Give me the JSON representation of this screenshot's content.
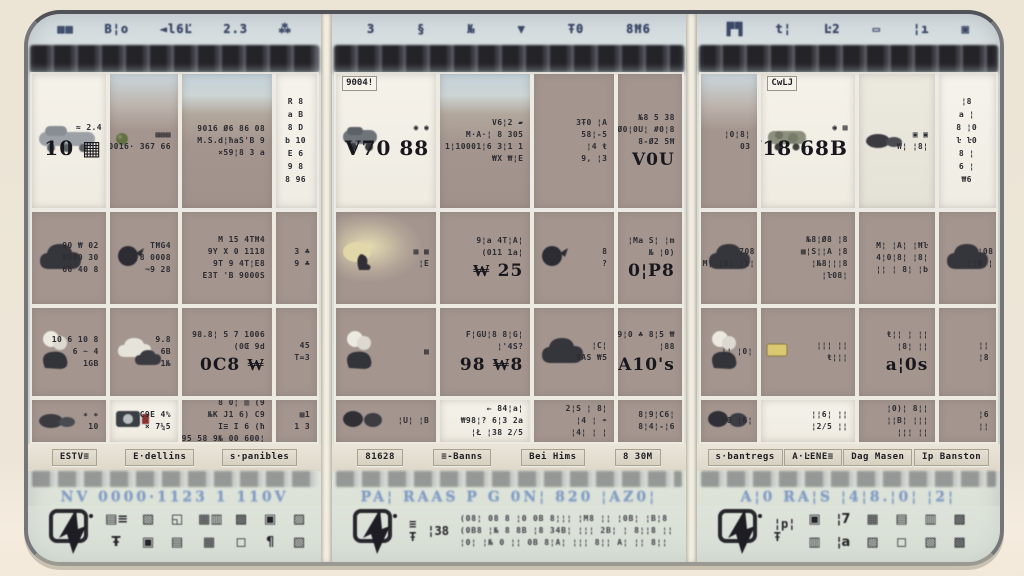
{
  "palette": {
    "outer_bg": "#ece5d6",
    "card_bg": "#d8dcd4",
    "cell_taupe": "#a5968e",
    "cell_white": "#f4f0e7",
    "band_dark": "#2c2c31",
    "blue_text": "#7e9cc7",
    "ink": "#24242a",
    "tab_bg": "#ded8c9",
    "red_accent": "#8d2f2f"
  },
  "panels": [
    {
      "top_glyphs": [
        "▩▦",
        "B¦o",
        "◄l6Ľ",
        "2.3",
        "⁂"
      ],
      "cells": [
        {
          "bg": "white",
          "caption": "",
          "icon": "truck-icon",
          "lines": [
            "≈ 2.4"
          ],
          "big": "10 ▦"
        },
        {
          "bg": "taupe1",
          "caption": "",
          "icon": "dot-green-icon",
          "lines": [
            "▦▦▦",
            "0016· 367 66"
          ],
          "big": ""
        },
        {
          "bg": "photo",
          "caption": "",
          "icon": "",
          "lines": [
            "9016 Ø6 86 08",
            "M.S.d¦ħaS'B 9",
            "×59¦8 3 a"
          ],
          "big": ""
        },
        {
          "bg": "strip",
          "caption": "",
          "icon": "",
          "lines": [
            "R 8",
            "a B",
            "8 D",
            "b 10",
            "E 6",
            "9 8",
            "8 96"
          ],
          "big": ""
        },
        {
          "bg": "taupe",
          "caption": "",
          "icon": "cloud-dark-icon",
          "lines": [
            "90 ₩ 02",
            "0900 30",
            "66 40 8"
          ],
          "big": ""
        },
        {
          "bg": "taupe",
          "caption": "",
          "icon": "bird-icon",
          "lines": [
            "TĦG4",
            "8 0008",
            "¬9 28"
          ],
          "big": ""
        },
        {
          "bg": "taupe",
          "caption": "",
          "icon": "",
          "lines": [
            "M 15 4TĦ4",
            "9Y X 0 1118",
            "9T 9 4T¦E8",
            "E3T 'B 9000S"
          ],
          "big": ""
        },
        {
          "bg": "taupe",
          "caption": "",
          "icon": "",
          "lines": [
            "3 ♣",
            "9 ♣"
          ],
          "big": ""
        },
        {
          "bg": "taupe",
          "caption": "",
          "icon": "cloud-smoke-icon",
          "lines": [
            "10 6 10 8",
            "6 ~ 4",
            "1GB"
          ],
          "big": ""
        },
        {
          "bg": "taupe",
          "caption": "",
          "icon": "cloud-white-icon",
          "lines": [
            "9.8",
            "6B",
            "1№"
          ],
          "big": ""
        },
        {
          "bg": "taupe",
          "caption": "",
          "icon": "",
          "lines": [
            "98.8¦ 5 7 1006",
            "(0Œ 9d"
          ],
          "big": "0C8 ₩"
        },
        {
          "bg": "taupe",
          "caption": "",
          "icon": "",
          "lines": [
            "45",
            "T=3"
          ],
          "big": ""
        },
        {
          "bg": "taupe",
          "caption": "",
          "icon": "gravel-icon",
          "lines": [
            "∗ ∗",
            "10"
          ],
          "big": ""
        },
        {
          "bg": "white",
          "caption": "",
          "icon": "camera-icon",
          "lines": [
            "C9E 4%",
            "× 7¼5"
          ],
          "big": ""
        },
        {
          "bg": "taupe",
          "caption": "",
          "icon": "",
          "lines": [
            "8 0¦ ▥ (9",
            "№K J1 6) C9",
            "I≡ I 6 (ħ",
            "95 58 9№ 00 600¦"
          ],
          "big": ""
        },
        {
          "bg": "taupe",
          "caption": "",
          "icon": "",
          "lines": [
            "▦1",
            "1 3"
          ],
          "big": ""
        }
      ],
      "tabs": [
        "ESTV≡",
        "E·dellins",
        "s·panibles"
      ],
      "blue_text": "NV 0000·1123 1 110V",
      "dock": {
        "main_icon": "cursor-flag-icon",
        "side": [],
        "glyph_rows": [
          [
            "▤≡",
            "▧",
            "◱",
            "▦▥",
            "▩",
            "▣",
            "▨"
          ],
          [
            "Ŧ",
            "▣",
            "▤",
            "▦",
            "◻",
            "¶",
            "▧"
          ]
        ],
        "text_rows": []
      }
    },
    {
      "top_glyphs": [
        "3",
        "§",
        "№",
        "▼",
        "Ŧ0",
        "8Ħ6"
      ],
      "cells": [
        {
          "bg": "white",
          "caption": "9004!",
          "icon": "van-icon",
          "lines": [
            "◉ ◉"
          ],
          "big": "V70 88"
        },
        {
          "bg": "photo",
          "caption": "",
          "icon": "",
          "lines": [
            "V6¦2 ▰",
            "M·A·¦ 8 305",
            "1¦10001¦6 3¦1 1",
            "₩X ₩¦E"
          ],
          "big": ""
        },
        {
          "bg": "taupe",
          "caption": "",
          "icon": "",
          "lines": [
            "3Ŧ0 ¦A",
            "58¦-5",
            "¦4 ŧ",
            "9, ¦3"
          ],
          "big": ""
        },
        {
          "bg": "taupe",
          "caption": "",
          "icon": "",
          "lines": [
            "№8 5 38",
            "9Ø0¦0U¦ #0¦8",
            "8-Ø2 5Ħ"
          ],
          "big": "V0U"
        },
        {
          "bg": "photo2",
          "caption": "",
          "icon": "figure-icon",
          "lines": [
            "▦ ▦",
            "¦E"
          ],
          "big": ""
        },
        {
          "bg": "taupe",
          "caption": "",
          "icon": "",
          "lines": [
            "9¦a 4T¦A¦",
            "(011 1a¦"
          ],
          "big": "₩ 25"
        },
        {
          "bg": "taupe",
          "caption": "",
          "icon": "bird-icon",
          "lines": [
            "8",
            "?"
          ],
          "big": ""
        },
        {
          "bg": "taupe",
          "caption": "",
          "icon": "",
          "lines": [
            "¦Ma S¦ ¦m",
            "№ ¦0)"
          ],
          "big": "0¦P8"
        },
        {
          "bg": "taupe",
          "caption": "",
          "icon": "cloud-smoke-icon",
          "lines": [
            "▦"
          ],
          "big": ""
        },
        {
          "bg": "taupe",
          "caption": "",
          "icon": "",
          "lines": [
            "F¦GU¦8 8¦G¦",
            "¦'4S?"
          ],
          "big": "98 ₩8"
        },
        {
          "bg": "taupe",
          "caption": "",
          "icon": "cloud-dark-icon",
          "lines": [
            "¦C¦",
            "8AS ₩5"
          ],
          "big": ""
        },
        {
          "bg": "taupe",
          "caption": "",
          "icon": "",
          "lines": [
            "9¦0 ♣ 8¦5 ₩",
            "¦88"
          ],
          "big": "A10's"
        },
        {
          "bg": "taupe",
          "caption": "",
          "icon": "blob-pair-icon",
          "lines": [
            "¦U¦ ¦B"
          ],
          "big": ""
        },
        {
          "bg": "white",
          "caption": "",
          "icon": "",
          "lines": [
            "← 84¦a¦",
            "₩98¦? 6¦3 2a",
            "¦Ł ¦38 2/5"
          ],
          "big": ""
        },
        {
          "bg": "taupe",
          "caption": "",
          "icon": "",
          "lines": [
            "2¦S ¦ 8¦",
            "¦4 ¦ ☂",
            "¦4¦ ¦ ¦"
          ],
          "big": ""
        },
        {
          "bg": "taupe",
          "caption": "",
          "icon": "",
          "lines": [
            "8¦9¦C6¦",
            "8¦4¦-¦6"
          ],
          "big": ""
        }
      ],
      "tabs": [
        "81628",
        "≡-Banns",
        "Bei Hims",
        "8 30M"
      ],
      "blue_text": "PA¦ RAAS P G 0N¦ 820 ¦AZ0¦",
      "dock": {
        "main_icon": "cursor-flag-icon",
        "side": [
          "≡\nŦ",
          "¦38"
        ],
        "glyph_rows": [],
        "text_rows": [
          "(08¦ 08 8 ¦0 0B 8¦¦¦ ¦M8 ¦¦ ¦0B¦ ¦B¦8",
          "(0B8 ¦№ 8 8B ¦8 34B¦ ¦¦¦ 2B¦ ¦ 8¦¦8 ¦¦¦",
          "¦0¦ ¦№ 0 ¦¦ 0B 8¦A¦ ¦¦¦ 8¦¦ A¦ ¦¦ 8¦¦"
        ]
      }
    },
    {
      "top_glyphs": [
        "▛▜",
        "t¦",
        "Ŀ2",
        "▭",
        "¦ı",
        "▣"
      ],
      "cells": [
        {
          "bg": "taupe1",
          "caption": "",
          "icon": "",
          "lines": [
            "¦0¦8¦",
            "03"
          ],
          "big": ""
        },
        {
          "bg": "white",
          "caption": "CwLJ",
          "icon": "jeep-icon",
          "lines": [
            "◉ ▦"
          ],
          "big": "VW18 68B"
        },
        {
          "bg": "white2",
          "caption": "",
          "icon": "gravel-icon",
          "lines": [
            "▣ ▣",
            "₩¦ ¦8¦"
          ],
          "big": ""
        },
        {
          "bg": "strip",
          "caption": "",
          "icon": "",
          "lines": [
            "¦8",
            "a ¦",
            "8 ¦0",
            "ŀ ŀ0",
            "8 ¦",
            "6 ¦",
            "₩6"
          ],
          "big": ""
        },
        {
          "bg": "taupe",
          "caption": "",
          "icon": "cloud-dark-icon",
          "lines": [
            "708",
            "M¦ ¦4¦ ¦ŀ¦"
          ],
          "big": ""
        },
        {
          "bg": "taupe",
          "caption": "",
          "icon": "",
          "lines": [
            "№8¦Ø8 ¦8",
            "▩¦S¦¦A ¦8",
            "¦№8¦¦¦8",
            "¦ŀ08¦"
          ],
          "big": ""
        },
        {
          "bg": "taupe",
          "caption": "",
          "icon": "",
          "lines": [
            "M¦ ¦A¦ ¦Ħŀ",
            "4¦0¦8¦ ¦8¦",
            "¦¦ ¦ 8¦ ¦b"
          ],
          "big": ""
        },
        {
          "bg": "taupe",
          "caption": "",
          "icon": "cloud-dark-icon",
          "lines": [
            "¦08",
            "¦¦8 ¦"
          ],
          "big": ""
        },
        {
          "bg": "taupe",
          "caption": "",
          "icon": "cloud-smoke-icon",
          "lines": [
            "¦¦ ¦0¦"
          ],
          "big": ""
        },
        {
          "bg": "taupe",
          "caption": "",
          "icon": "tag-yellow-icon",
          "lines": [
            "¦¦¦ ¦¦",
            "ŧ¦¦¦"
          ],
          "big": ""
        },
        {
          "bg": "taupe",
          "caption": "",
          "icon": "",
          "lines": [
            "ŧ¦¦ ¦ ¦¦",
            "¦8¦ ¦¦"
          ],
          "big": "a¦0s"
        },
        {
          "bg": "taupe",
          "caption": "",
          "icon": "",
          "lines": [
            "¦¦",
            "¦8"
          ],
          "big": ""
        },
        {
          "bg": "taupe",
          "caption": "",
          "icon": "blob-pair-icon",
          "lines": [
            "¦0 ¦6¦"
          ],
          "big": ""
        },
        {
          "bg": "white",
          "caption": "",
          "icon": "",
          "lines": [
            "¦¦6¦ ¦¦",
            "¦2/5 ¦¦"
          ],
          "big": ""
        },
        {
          "bg": "taupe",
          "caption": "",
          "icon": "",
          "lines": [
            "¦0)¦ 8¦¦",
            "¦¦B¦ ¦¦¦",
            "¦¦¦ ¦¦"
          ],
          "big": ""
        },
        {
          "bg": "taupe",
          "caption": "",
          "icon": "",
          "lines": [
            "¦6",
            "¦¦"
          ],
          "big": ""
        }
      ],
      "tabs": [
        "s·bantregs",
        "A·ĿENE≡",
        "Dag Masen",
        "Ip Banston"
      ],
      "blue_text": "A¦0 RA¦S ¦4¦8.¦0¦ ¦2¦",
      "dock": {
        "main_icon": "cursor-flag-icon",
        "side": [
          "¦p¦\nŦ"
        ],
        "glyph_rows": [
          [
            "▣",
            "¦7",
            "▦",
            "▤",
            "▥",
            "▩"
          ],
          [
            "▥",
            "¦a",
            "▨",
            "◻",
            "▧",
            "▩"
          ]
        ],
        "text_rows": []
      }
    }
  ]
}
